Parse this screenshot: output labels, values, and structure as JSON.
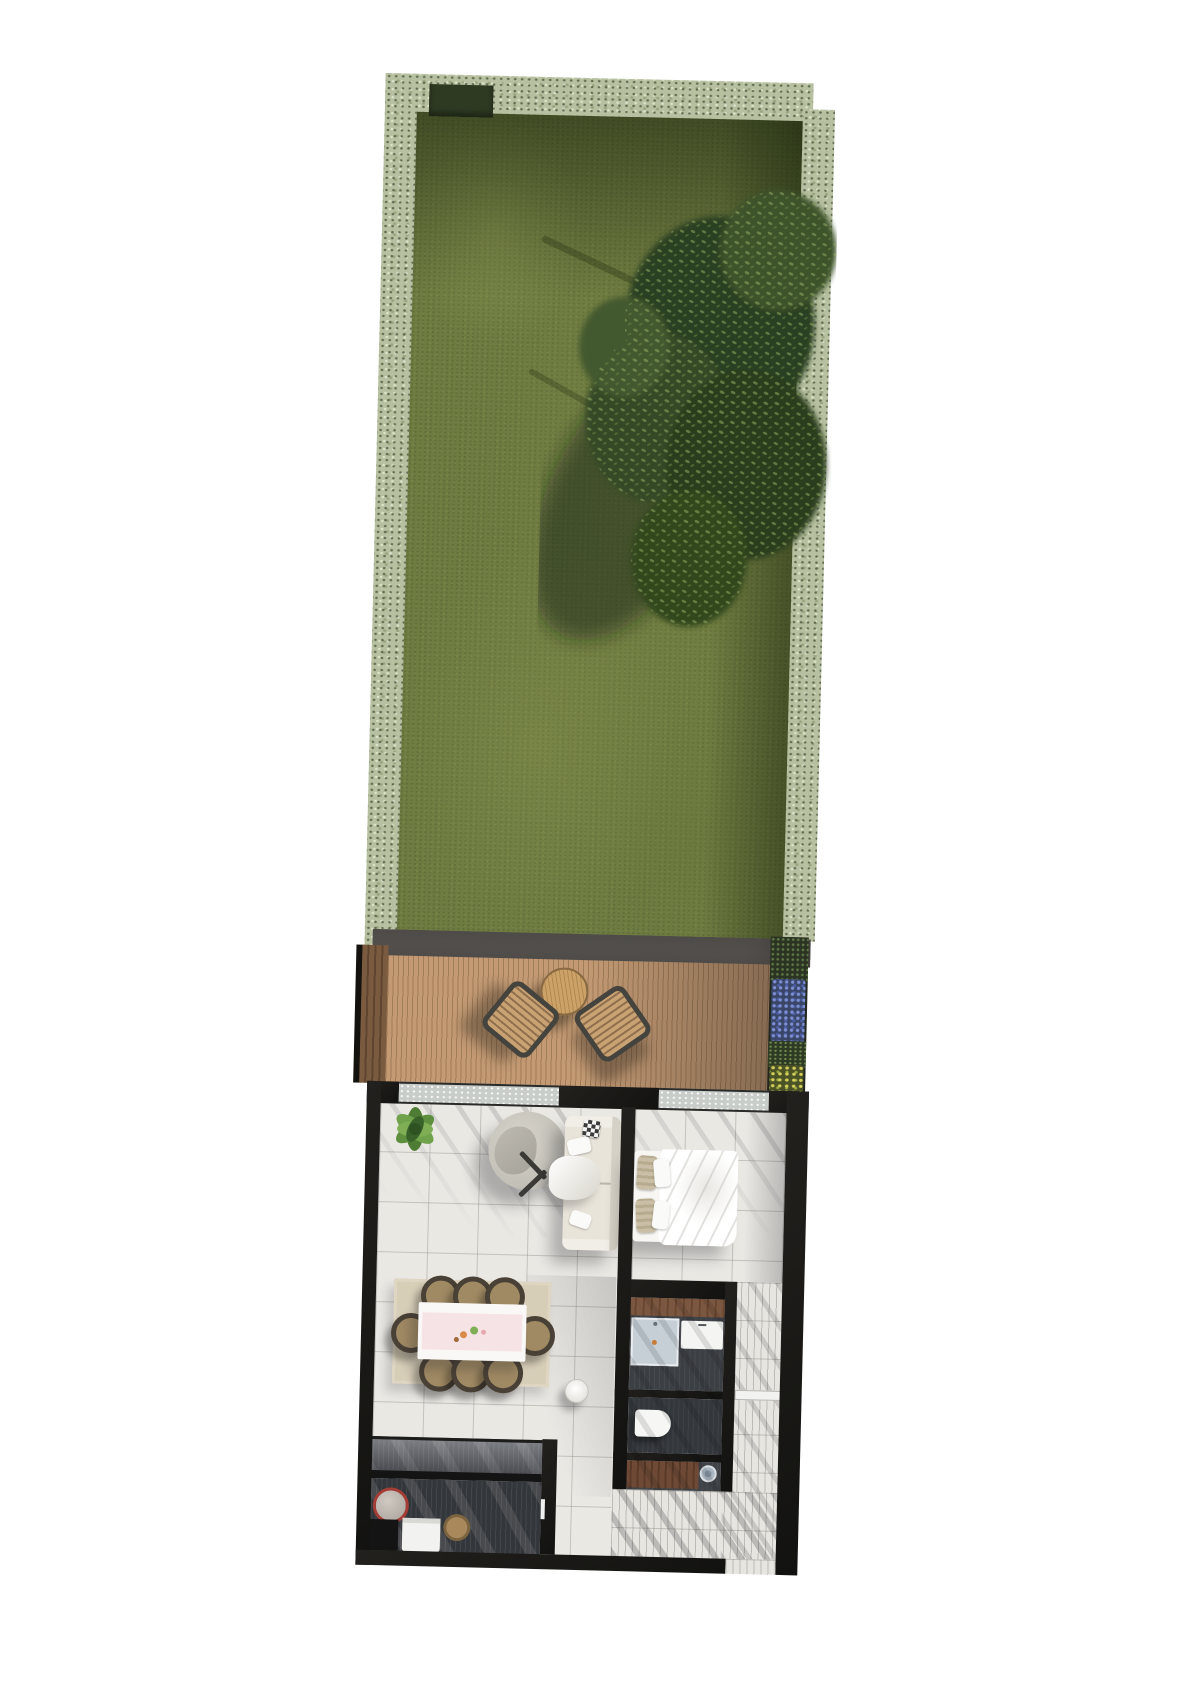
{
  "document": {
    "title": "Top-down 3D render floor plan of a one-bedroom garden apartment"
  },
  "colors": {
    "background": "#ffffff",
    "lawn": "#6e7b41",
    "hedge": "#b7c1a1",
    "tree_canopy": "#2d4021",
    "deck_wood": "#c39a74",
    "edge_strip": "#595653",
    "wall": "#1a1917",
    "interior_tile": "#eae8e3",
    "bath_floor": "#3c3f44",
    "vanity_wood": "#7b5741",
    "sofa": "#e9e4da",
    "rug": "#d7ceb8",
    "table_runner": "#f6e3e6",
    "sink_red_rim": "#a33c34",
    "planter_blue": "#6b80c8",
    "planter_yellow": "#c6c353"
  },
  "areas": {
    "garden": {
      "label": "Garden lawn bordered by hedges with a large tree"
    },
    "deck": {
      "label": "Timber deck terrace with round table and two chairs"
    },
    "planter": {
      "label": "Raised planter with blue and yellow flowers"
    },
    "living": {
      "label": "Living room with sofa, round lounge chair and potted plant"
    },
    "dining": {
      "label": "Dining area with table for eight on a rug"
    },
    "kitchen": {
      "label": "Galley kitchen with island counter, round sink and oven"
    },
    "bedroom": {
      "label": "Bedroom with double bed"
    },
    "bathroom": {
      "label": "Shower room with walk-in shower and basin"
    },
    "wc": {
      "label": "WC with toilet"
    },
    "laundry": {
      "label": "Laundry nook with washing machine under counter"
    },
    "hallway": {
      "label": "Entrance hallway along the right side"
    }
  },
  "furniture": {
    "tree": {
      "label": "Large garden tree casting shadow on lawn"
    },
    "deck_table": {
      "label": "Round timber outdoor table"
    },
    "deck_chair_1": {
      "label": "Slatted outdoor chair, left"
    },
    "deck_chair_2": {
      "label": "Slatted outdoor chair, right"
    },
    "plant": {
      "label": "Indoor potted plant"
    },
    "lounge": {
      "label": "Round lounge chair with throw"
    },
    "sofa": {
      "label": "Cream three-seat sofa with checkered cushion"
    },
    "stool": {
      "label": "Small round side table"
    },
    "dining_table": {
      "label": "Dining table with pink runner and decor"
    },
    "dining_chairs": {
      "label": "Eight round-back dining chairs",
      "count": 8
    },
    "island": {
      "label": "Kitchen island counter"
    },
    "kitchen_counter": {
      "label": "Kitchen counter with round red-rim sink, oven and bowl"
    },
    "bed": {
      "label": "Double bed with white duvet and beige pillows"
    },
    "shower": {
      "label": "Walk-in shower tray"
    },
    "basin": {
      "label": "Washbasin"
    },
    "toilet": {
      "label": "Toilet"
    },
    "washer": {
      "label": "Washing machine"
    },
    "hall_door": {
      "label": "White internal door"
    },
    "sliding_door": {
      "label": "Glazed sliding door to deck"
    },
    "bedroom_window": {
      "label": "Glazed bedroom window to deck"
    }
  }
}
